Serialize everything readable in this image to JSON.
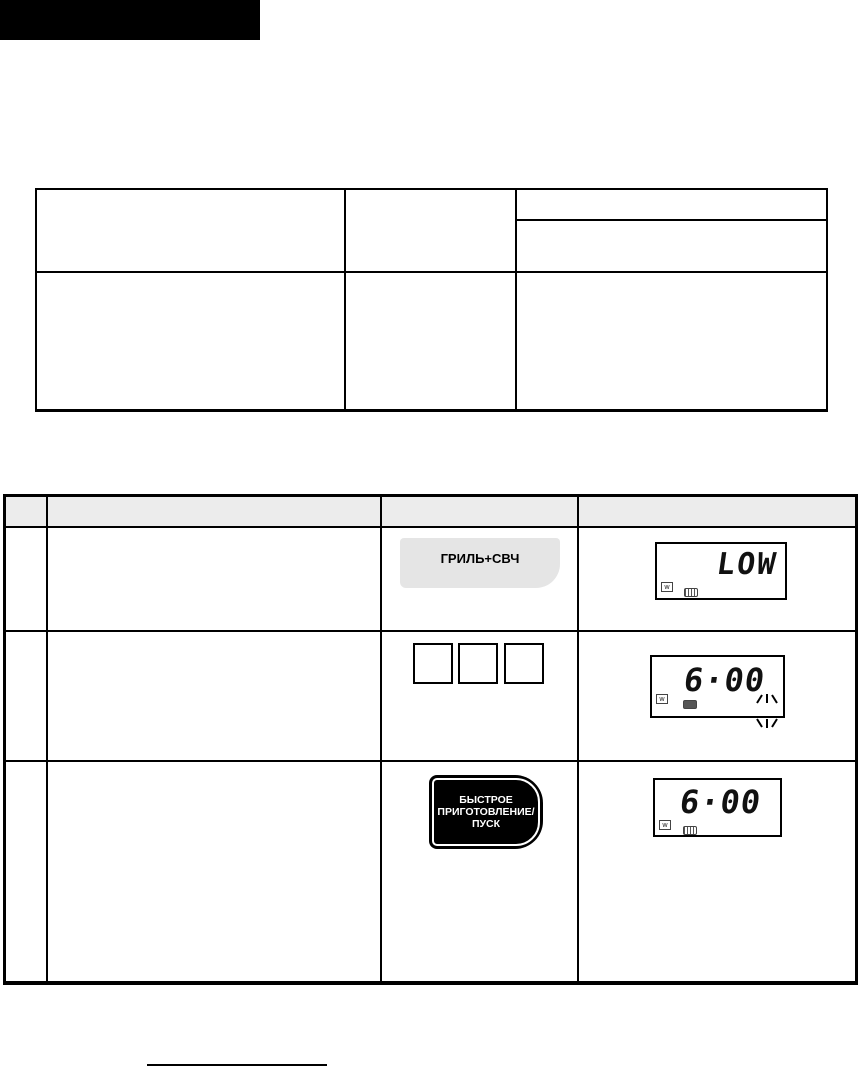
{
  "header_bar": {
    "color": "#000000"
  },
  "reference_table": {
    "columns": 3,
    "rows": 2,
    "header_col3_split": true,
    "content": "empty"
  },
  "steps_table": {
    "header_bg": "#ececec",
    "columns": 4,
    "steps": [
      {
        "button_label": "ГРИЛЬ+СВЧ",
        "button_bg": "#e5e5e5",
        "display": {
          "value": "LOW",
          "icons": [
            "microwave-power",
            "grill"
          ]
        }
      },
      {
        "keypad_keys": 3,
        "display": {
          "value": "6·00",
          "icons": [
            "microwave-power",
            "grill"
          ],
          "sparkle_marks": true
        }
      },
      {
        "button_label_lines": [
          "БЫСТРОЕ",
          "ПРИГОТОВЛЕНИЕ/",
          "ПУСК"
        ],
        "button_bg": "#000000",
        "button_text_color": "#ffffff",
        "display": {
          "value": "6·00",
          "icons": [
            "microwave-power",
            "grill"
          ]
        }
      }
    ]
  },
  "glyphs": {
    "microwave_power": "w"
  },
  "footnote_rule": true
}
